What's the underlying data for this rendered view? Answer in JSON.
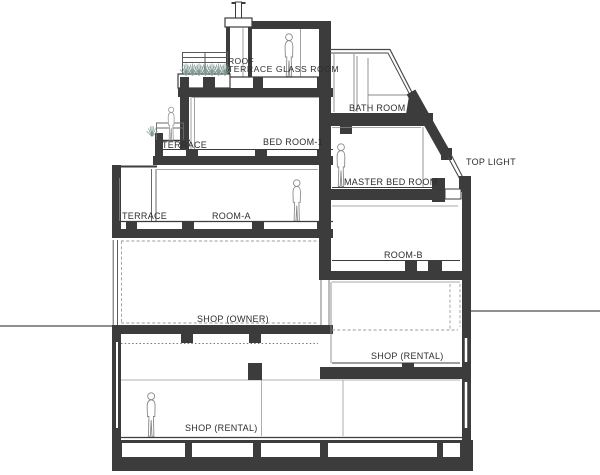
{
  "drawing": {
    "type": "architectural cross-section",
    "people_count": 5,
    "plant_count": 8
  },
  "colors": {
    "wall": "#3c3c3c",
    "thin_line": "#5a5a5a",
    "light_line": "#8a8a8a",
    "dashed_line": "#9b9b9b",
    "ground_line": "#8f8f8f",
    "plant": "#7d9894",
    "text": "#2d2d2d",
    "background": "#ffffff"
  },
  "labels": {
    "roof_line1": "ROOF",
    "roof_line2": "TERRACE GLASS ROOM",
    "bath_room": "BATH ROOM",
    "terrace_upper": "TERRACE",
    "bed_room_1": "BED ROOM-1",
    "master_bed_room": "MASTER BED ROOM",
    "top_light": "TOP LIGHT",
    "terrace_lower": "TERRACE",
    "room_a": "ROOM-A",
    "room_b": "ROOM-B",
    "shop_owner": "SHOP (OWNER)",
    "shop_rental_upper": "SHOP (RENTAL)",
    "shop_rental_lower": "SHOP (RENTAL)"
  }
}
